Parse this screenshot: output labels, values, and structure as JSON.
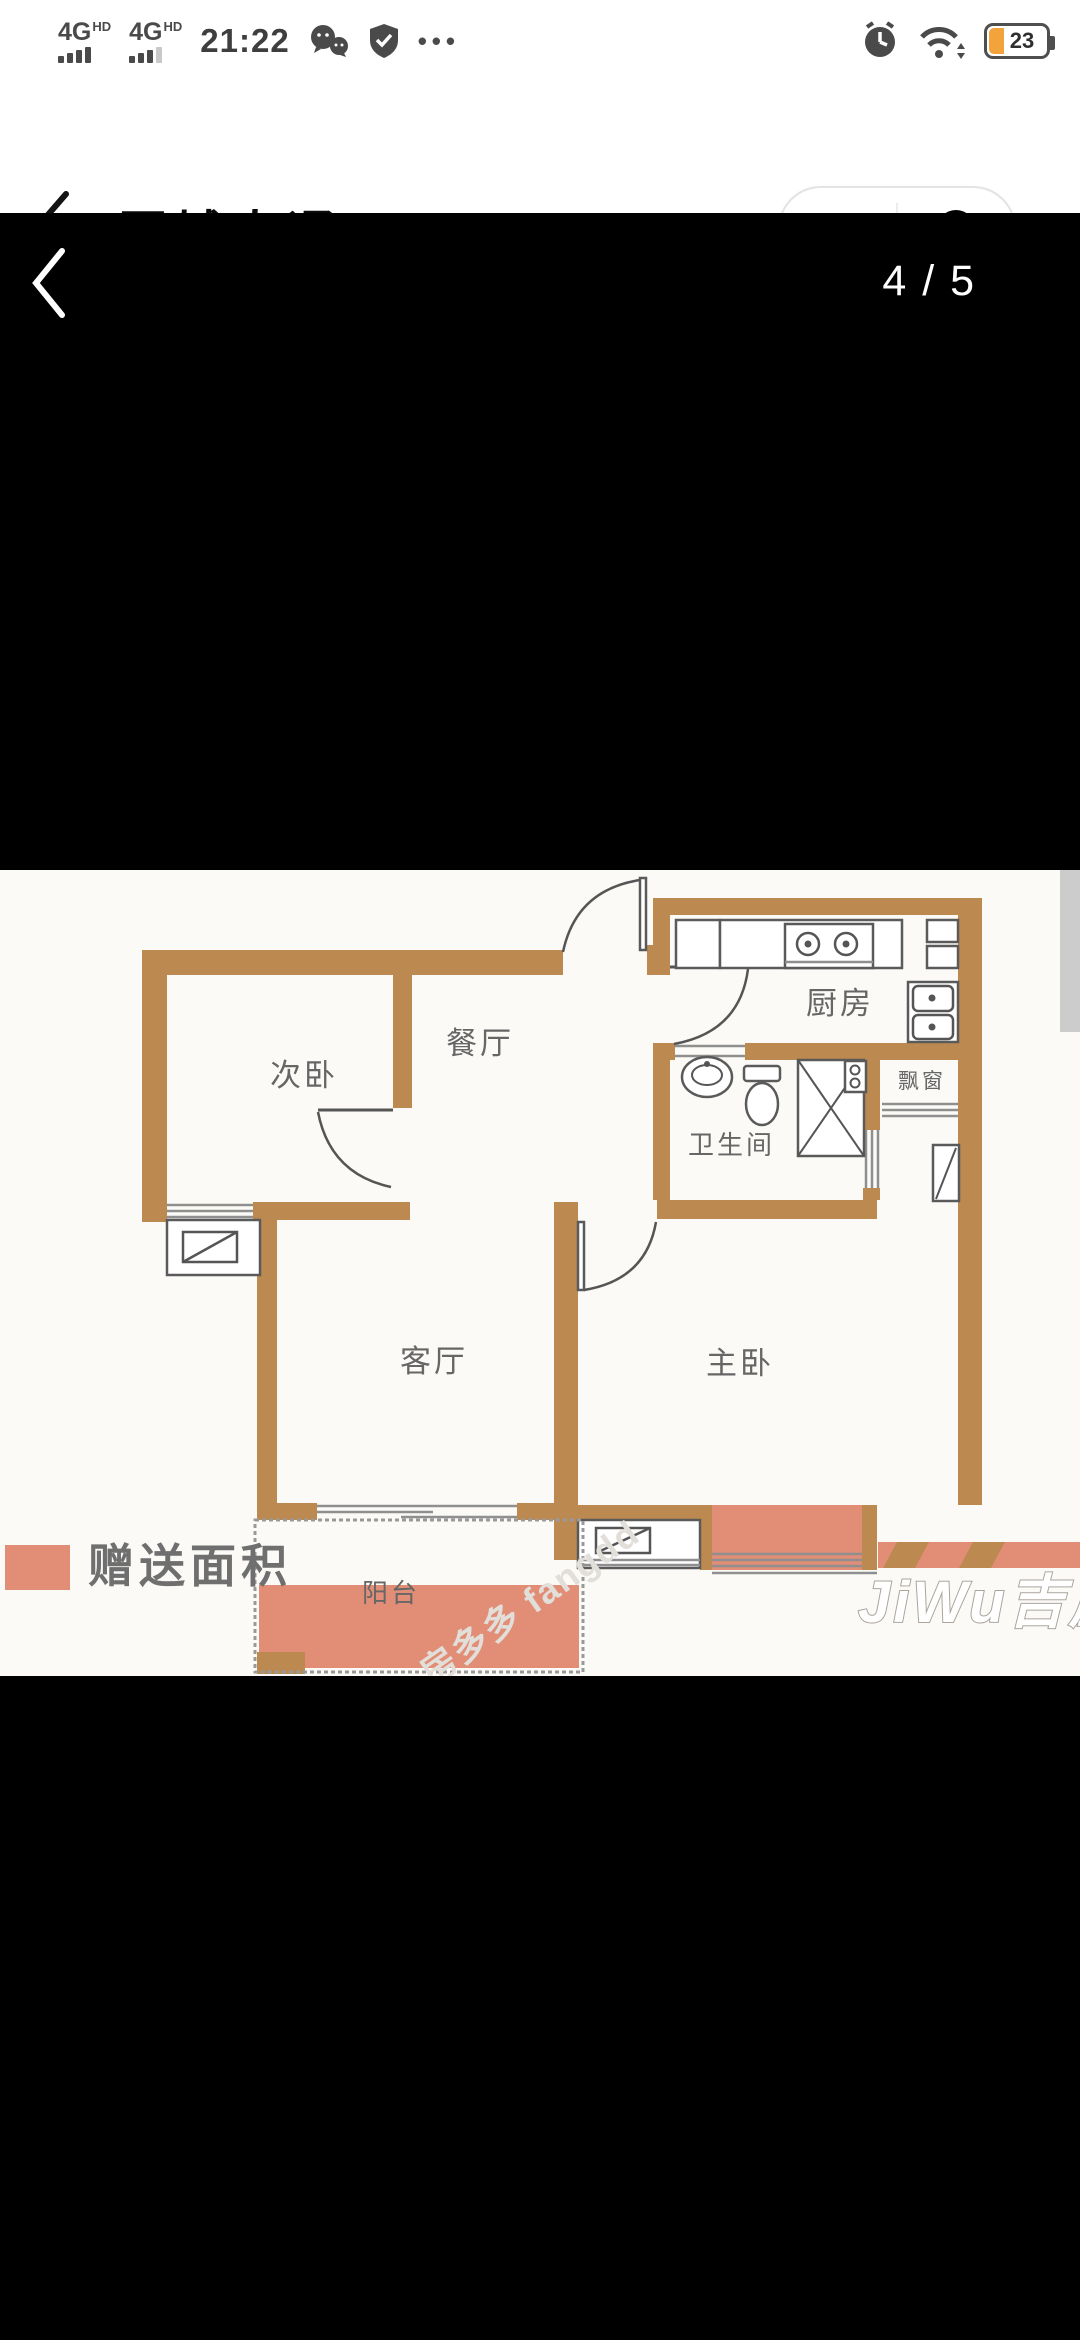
{
  "colors": {
    "wall": "#bc8a50",
    "gift": "#e28e76",
    "plan_bg": "#fbfaf7",
    "accent_battery": "#f2a33c"
  },
  "status_bar": {
    "sim1": "4G",
    "sim1_badge": "HD",
    "sim2": "4G",
    "sim2_badge": "HD",
    "time": "21:22",
    "battery": "23",
    "icons": [
      "dual-sim-signal",
      "wechat",
      "security-shield",
      "more-dots",
      "alarm-clock",
      "wifi",
      "battery"
    ]
  },
  "header": {
    "title": "冠城大通"
  },
  "viewer": {
    "page_indicator": "4 / 5"
  },
  "plan": {
    "rooms": {
      "second_bedroom": "次卧",
      "dining": "餐厅",
      "kitchen": "厨房",
      "bathroom": "卫生间",
      "bay_window": "飘窗",
      "living": "客厅",
      "master_bedroom": "主卧",
      "balcony": "阳台"
    },
    "legend_label": "赠送面积",
    "watermarks": {
      "jiwu": "JiWu吉屋",
      "fangdd": "房多多 fangdd"
    }
  }
}
